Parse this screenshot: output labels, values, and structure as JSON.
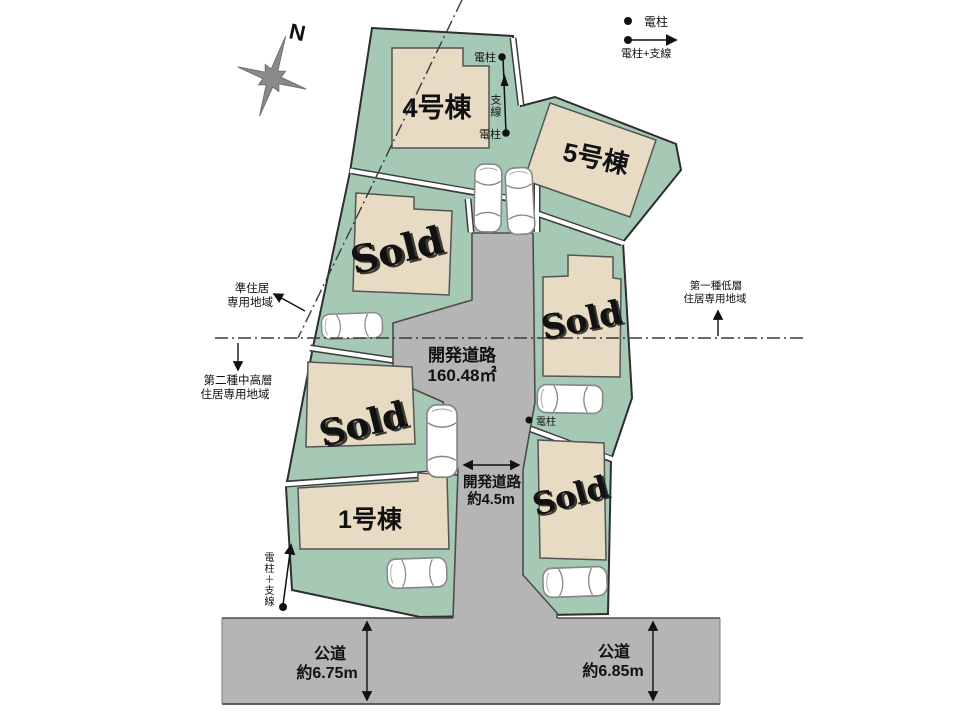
{
  "legend": {
    "pole_label": "電柱",
    "pole_wire_label": "電柱+支線"
  },
  "compass": {
    "north_label": "N"
  },
  "units": {
    "unit4_label": "4号棟",
    "unit5_label": "5号棟",
    "unit1_label": "1号棟"
  },
  "sold_label": "Sold",
  "dev_road": {
    "name": "開発道路",
    "area": "160.48㎡"
  },
  "dev_road_width": {
    "name": "開発道路",
    "width": "約4.5m"
  },
  "public_road_left": {
    "name": "公道",
    "width": "約6.75m"
  },
  "public_road_right": {
    "name": "公道",
    "width": "約6.85m"
  },
  "zoning": {
    "quasi_residential_line1": "準住居",
    "quasi_residential_line2": "専用地域",
    "second_midhigh_line1": "第二種中高層",
    "second_midhigh_line2": "住居専用地域",
    "first_lowrise_line1": "第一種低層",
    "first_lowrise_line2": "住居専用地域"
  },
  "poles": {
    "upper_label": "電柱",
    "wire_label": "支線",
    "lower_label": "電柱",
    "mid_label": "電柱",
    "bottom_vertical_label": "電柱＋支線"
  },
  "colors": {
    "lot_green": "#a6c9b6",
    "building_beige": "#e8dbc4",
    "road_gray": "#b5b5b5",
    "sold_red": "#b2252a"
  }
}
